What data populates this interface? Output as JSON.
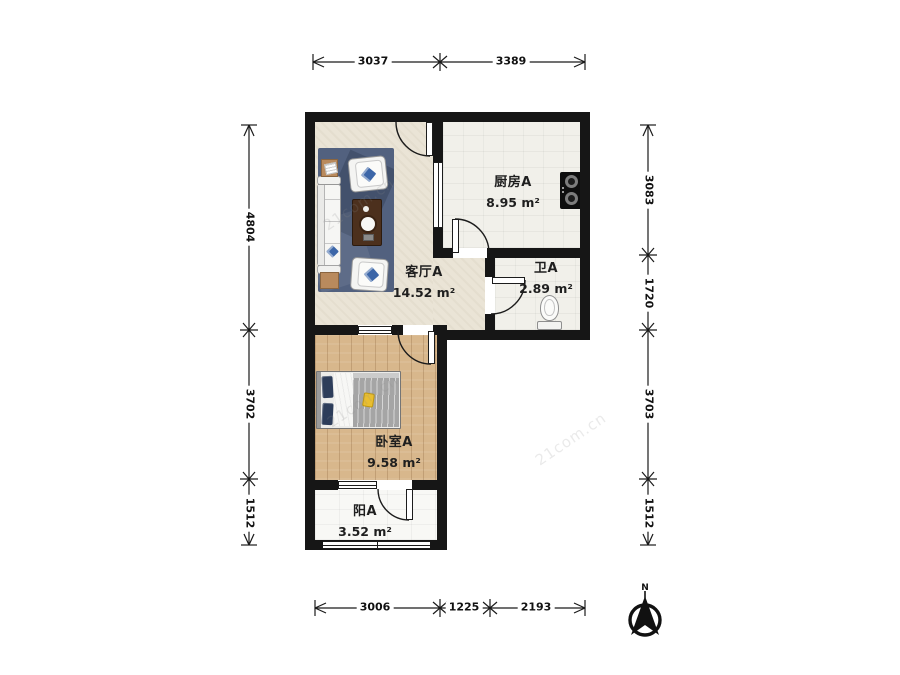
{
  "rooms": [
    {
      "id": "living",
      "name": "客厅A",
      "area": "14.52 m²"
    },
    {
      "id": "kitchen",
      "name": "厨房A",
      "area": "8.95 m²"
    },
    {
      "id": "bath",
      "name": "卫A",
      "area": "2.89 m²"
    },
    {
      "id": "bedroom",
      "name": "卧室A",
      "area": "9.58 m²"
    },
    {
      "id": "balcony",
      "name": "阳A",
      "area": "3.52 m²"
    }
  ],
  "dimensions": {
    "top": [
      "3037",
      "3389"
    ],
    "bottom": [
      "3006",
      "1225",
      "2193"
    ],
    "left": [
      "4804",
      "3702",
      "1512"
    ],
    "right": [
      "3083",
      "1720",
      "3703",
      "1512"
    ]
  },
  "compass": {
    "label": "N"
  },
  "watermark": {
    "text": "21com.cn"
  },
  "colors": {
    "wall": "#161616",
    "living_floor": "#eae4d6",
    "wood_floor": "#d8b78c",
    "tile_floor": "#f1f0ea",
    "rug": "#52617f",
    "pillow_blue": "#3c66a8",
    "coffee_table": "#4c301d",
    "bed_blanket": "#a5a5a5",
    "accent_yellow": "#e9be2f"
  }
}
